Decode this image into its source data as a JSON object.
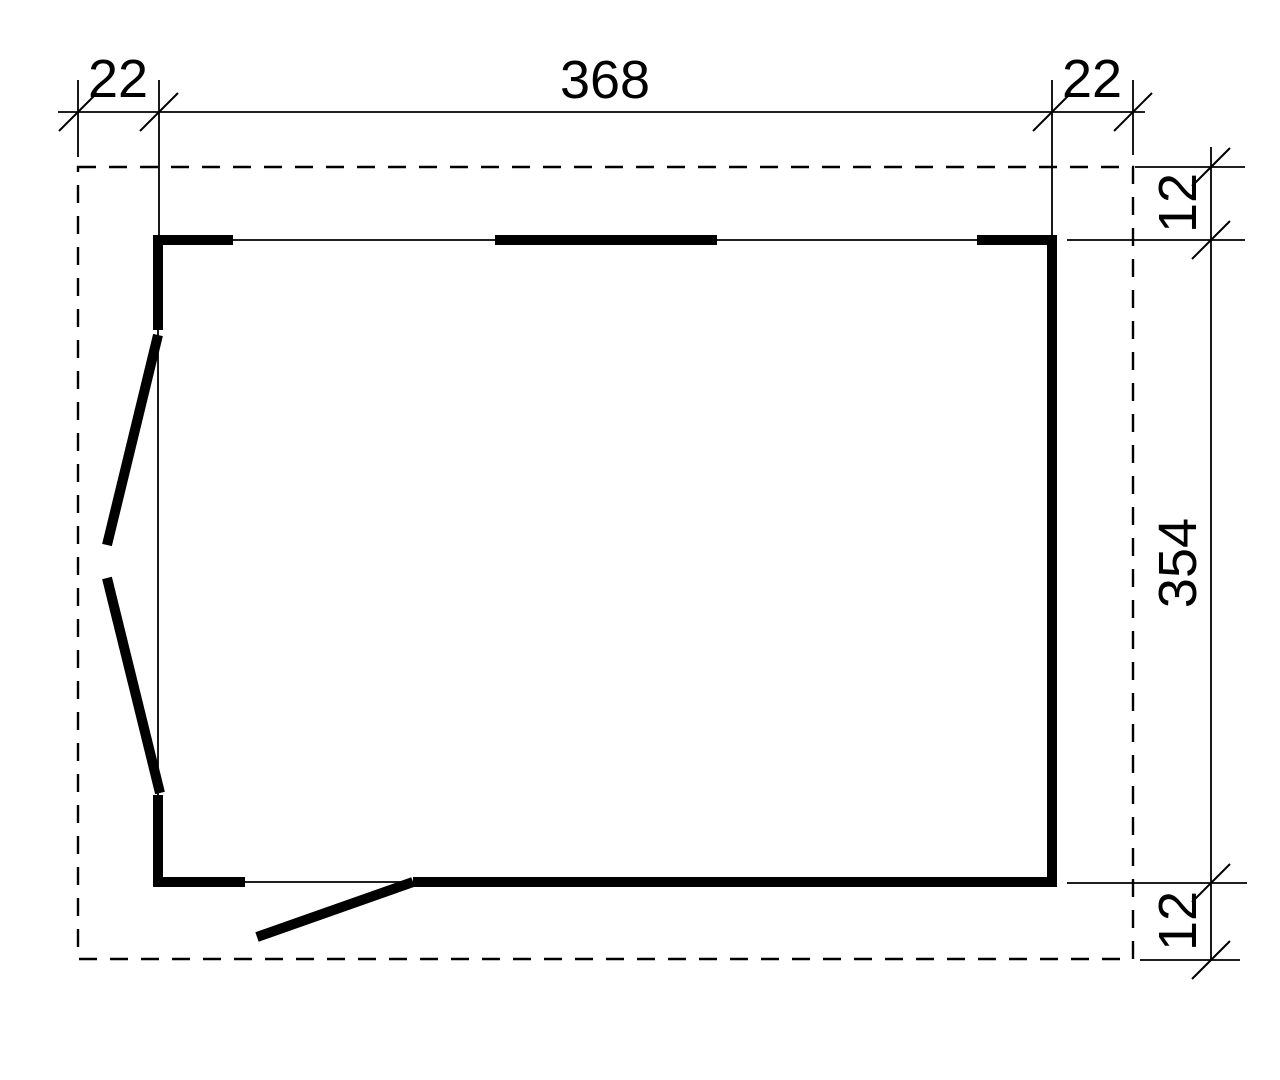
{
  "page": {
    "background": "#ffffff",
    "line_color": "#000000"
  },
  "drawing": {
    "kind": "floor-plan",
    "dims_top": {
      "left_overhang": "22",
      "width": "368",
      "right_overhang": "22"
    },
    "dims_right": {
      "top_overhang": "12",
      "height": "354",
      "bottom_overhang": "12"
    }
  }
}
